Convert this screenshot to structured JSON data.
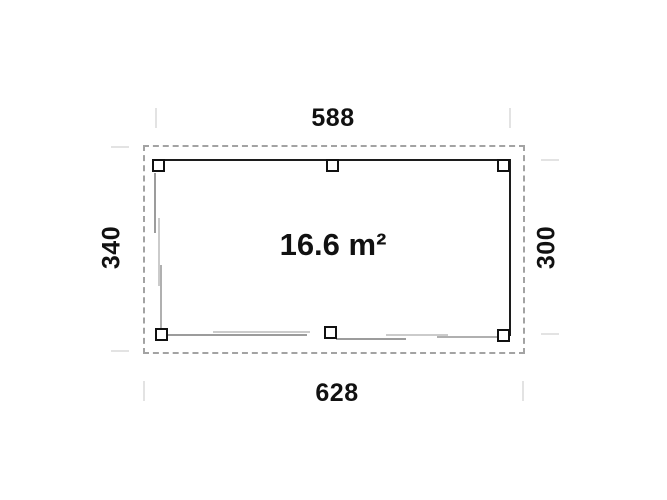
{
  "plan": {
    "area_label": "16.6 m²",
    "dimensions": {
      "top": "588",
      "bottom": "628",
      "left": "340",
      "right": "300"
    },
    "colors": {
      "wall": "#1c1c1c",
      "overhang_dashed": "#a3a3a3",
      "door_line_dark": "#9c9c9c",
      "door_line_light": "#cbcbcb",
      "extension_tick": "#e3e3e3",
      "text": "#111111",
      "background": "#ffffff"
    }
  }
}
